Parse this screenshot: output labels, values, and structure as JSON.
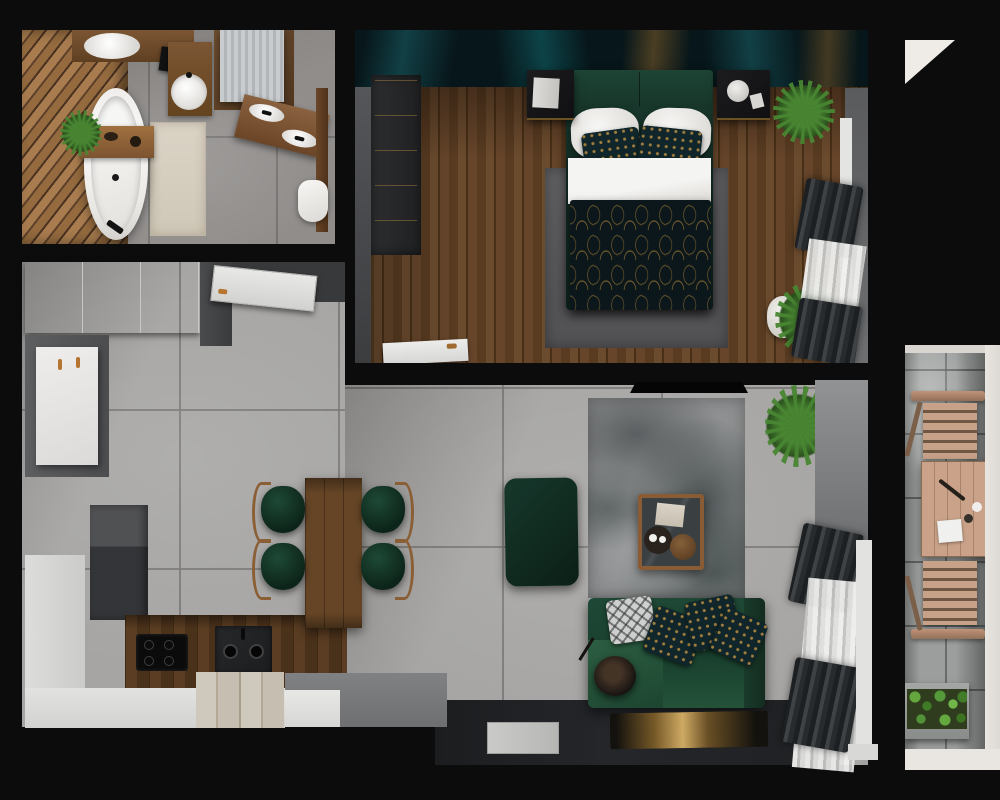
{
  "scene": {
    "type": "3d-apartment-floor-plan-top-view",
    "style": "photorealistic render, dark walls, green/teal and walnut accents",
    "rooms": [
      {
        "name": "bathroom",
        "position": "top-left",
        "items": [
          "diagonal-wood-slat-accent-wall",
          "freestanding-oval-bathtub",
          "wood-bath-caddy-with-plant",
          "beige-rug",
          "round-washbasin-on-wood-vanity",
          "wall-mirror",
          "washing-machine-in-wood-surround",
          "double-oval-sink-counter",
          "toilet",
          "gray-stone-tile-floor"
        ]
      },
      {
        "name": "bedroom",
        "position": "top-right",
        "items": [
          "teal-gold-marble-accent-wall",
          "dark-wardrobe",
          "double-bed-green-headboard",
          "white-pillows",
          "gold-patterned-accent-pillows",
          "white-folded-sheet",
          "dark-green-gold-arch-pattern-duvet",
          "gray-area-rug",
          "nightstand-with-books",
          "nightstand-with-lamp",
          "potted-plant-top",
          "potted-plant-bottom",
          "window-with-dark-curtains-and-sheers",
          "white-door",
          "dark-walnut-plank-floor"
        ]
      },
      {
        "name": "kitchen-dining",
        "position": "bottom-left",
        "items": [
          "white-wardrobe-cabinets",
          "open-white-entry-door",
          "tall-white-cabinet",
          "gray-cabinet-block",
          "white-worktop-strips",
          "walnut-l-counter",
          "black-induction-cooktop",
          "black-double-sink",
          "light-wood-boards",
          "gray-peninsula-slab",
          "walnut-dining-table",
          "four-green-wood-frame-chairs",
          "light-concrete-tile-floor"
        ]
      },
      {
        "name": "living-room",
        "position": "bottom-center-right",
        "items": [
          "wall-mounted-tv",
          "distressed-gray-rug",
          "wood-frame-coffee-table",
          "green-ottoman-pouf",
          "green-sofa-with-chaise",
          "patterned-sofa-pillows",
          "black-floor-lamp",
          "spiky-potted-plant",
          "dark-curtains-and-sheer-curtains",
          "white-window-frame",
          "dark-entry-floor-strip",
          "gray-doormat",
          "dark-gold-runner-rug"
        ]
      },
      {
        "name": "balcony",
        "position": "right-strip",
        "items": [
          "concrete-slab-floor",
          "two-folding-wood-chairs",
          "folding-wood-table-with-tableware",
          "green-planter-box",
          "white-outer-frame"
        ]
      }
    ]
  },
  "palette": {
    "wall-black": "#0c0c0d",
    "concrete-floor": "#a6a5a3",
    "bathroom-floor": "#908d8b",
    "wood-floor": "#5e422a",
    "wood-slat": "#a87c4e",
    "walnut-counter": "#54381f",
    "bed-green": "#1c4033",
    "sofa-green": "#1f4836",
    "duvet-dark": "#0c181b",
    "accent-teal": "#1a6269",
    "accent-gold": "#9e7836",
    "cabinet-white": "#eaeae8",
    "cabinet-gray": "#3f4042",
    "rug-gray": "#8e9091",
    "balcony-wood": "#c49e84",
    "plant-green": "#4e8a33"
  }
}
